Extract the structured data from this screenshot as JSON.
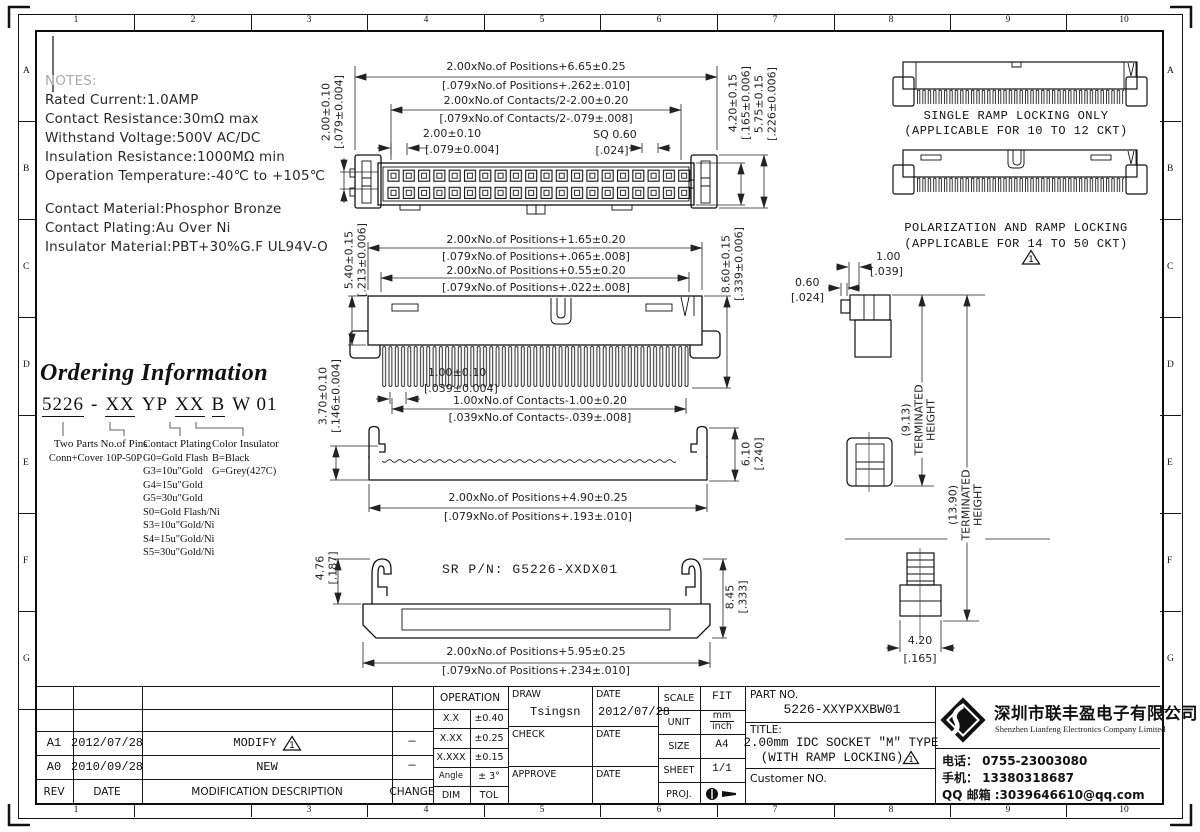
{
  "frame": {
    "top_numbers": [
      "1",
      "2",
      "3",
      "4",
      "5",
      "6",
      "7",
      "8",
      "9",
      "10"
    ],
    "bottom_numbers": [
      "1",
      "2",
      "3",
      "4",
      "5",
      "6",
      "7",
      "8",
      "9",
      "10"
    ],
    "left_letters": [
      "A",
      "B",
      "C",
      "D",
      "E",
      "F",
      "G"
    ],
    "right_letters": [
      "A",
      "B",
      "C",
      "D",
      "E",
      "F",
      "G"
    ]
  },
  "notes": {
    "heading": "NOTES:",
    "electrical": [
      "Rated Current:1.0AMP",
      "Contact Resistance:30mΩ max",
      "Withstand Voltage:500V AC/DC",
      "Insulation Resistance:1000MΩ min",
      "Operation Temperature:-40℃ to +105℃"
    ],
    "material": [
      "Contact Material:Phosphor Bronze",
      "Contact Plating:Au Over Ni",
      "Insulator Material:PBT+30%G.F UL94V-O"
    ]
  },
  "ordering": {
    "title": "Ordering Information",
    "code": {
      "seg1": "5226",
      "seg2": "-",
      "seg3": "XX",
      "seg4": "YP",
      "seg5": "XX",
      "seg6": "B",
      "seg7": "W 01"
    },
    "col1": {
      "line1": "Two Parts",
      "line2": "Conn+Cover"
    },
    "col2": {
      "line1": "No.of Pins",
      "line2": "10P-50P"
    },
    "col3": {
      "title": "Contact Plating",
      "options": [
        "G0=Gold Flash",
        "G3=10u\"Gold",
        "G4=15u\"Gold",
        "G5=30u\"Gold",
        "S0=Gold Flash/Ni",
        "S3=10u\"Gold/Ni",
        "S4=15u\"Gold/Ni",
        "S5=30u\"Gold/Ni"
      ]
    },
    "col4": {
      "title": "Color Insulator",
      "options": [
        "B=Black",
        "G=Grey(427C)"
      ]
    }
  },
  "dims": {
    "v1_pos_mm": "2.00xNo.of Positions+6.65±0.25",
    "v1_pos_in": "[.079xNo.of Positions+.262±.010]",
    "v1_cont_mm": "2.00xNo.of Contacts/2-2.00±0.20",
    "v1_cont_in": "[.079xNo.of Contacts/2-.079±.008]",
    "v1_pitch_mm": "2.00±0.10",
    "v1_pitch_in": "[.079±0.004]",
    "v1_sq_mm": "SQ 0.60",
    "v1_sq_in": "[.024]",
    "v1_row_mm": "2.00±0.10",
    "v1_row_in": "[.079±0.004]",
    "v1_h1_mm": "4.20±0.15",
    "v1_h1_in": "[.165±0.006]",
    "v1_h2_mm": "5.75±0.15",
    "v1_h2_in": "[.226±0.006]",
    "v2_pos1_mm": "2.00xNo.of Positions+1.65±0.20",
    "v2_pos1_in": "[.079xNo.of Positions+.065±.008]",
    "v2_pos2_mm": "2.00xNo.of Positions+0.55±0.20",
    "v2_pos2_in": "[.079xNo.of Positions+.022±.008]",
    "v2_left_mm": "5.40±0.15",
    "v2_left_in": "[.213±0.006]",
    "v2_right_mm": "8.60±0.15",
    "v2_right_in": "[.339±0.006]",
    "v2_pitch_mm": "1.00±0.10",
    "v2_pitch_in": "[.039±0.004]",
    "v2_cont_mm": "1.00xNo.of Contacts-1.00±0.20",
    "v2_cont_in": "[.039xNo.of Contacts-.039±.008]",
    "v2_wall_mm": "3.70±0.10",
    "v2_wall_in": "[.146±0.004]",
    "v3_h_mm": "6.10",
    "v3_h_in": "[.240]",
    "v3_pos_mm": "2.00xNo.of Positions+4.90±0.25",
    "v3_pos_in": "[.079xNo.of Positions+.193±.010]",
    "v4_srpn": "SR P/N: G5226-XXDX01",
    "v4_hook_mm": "4.76",
    "v4_hook_in": "[.187]",
    "v4_h_mm": "8.45",
    "v4_h_in": "[.333]",
    "v4_pos_mm": "2.00xNo.of Positions+5.95±0.25",
    "v4_pos_in": "[.079xNo.of Positions+.234±.010]",
    "s_w1_mm": "1.00",
    "s_w1_in": "[.039]",
    "s_w2_mm": "0.60",
    "s_w2_in": "[.024]",
    "s_th1": "(9.13)",
    "s_th2": "(13.90)",
    "s_th_l1": "TERMINATED",
    "s_th_l2": "HEIGHT",
    "s_base_mm": "4.20",
    "s_base_in": "[.165]"
  },
  "right_section": {
    "caption1_line1": "SINGLE RAMP LOCKING ONLY",
    "caption1_line2": "(APPLICABLE FOR 10 TO 12 CKT)",
    "caption2_line1": "POLARIZATION AND RAMP LOCKING",
    "caption2_line2": "(APPLICABLE FOR 14 TO 50 CKT)"
  },
  "rev_triangle": "1",
  "title_block": {
    "revisions": {
      "headers": {
        "rev": "REV",
        "date": "DATE",
        "desc": "MODIFICATION  DESCRIPTION",
        "change": "CHANGE"
      },
      "rows": [
        {
          "rev": "A1",
          "date": "2012/07/28",
          "desc": "MODIFY",
          "change": "—"
        },
        {
          "rev": "A0",
          "date": "2010/09/28",
          "desc": "NEW",
          "change": "—"
        }
      ]
    },
    "operation": {
      "header": "OPERATION",
      "rows": [
        [
          "X.X",
          "±0.40"
        ],
        [
          "X.XX",
          "±0.25"
        ],
        [
          "X.XXX",
          "±0.15"
        ],
        [
          "Angle",
          "± 3°"
        ],
        [
          "DIM",
          "TOL"
        ]
      ]
    },
    "sign": {
      "draw_label": "DRAW",
      "draw_name": "Tsingsn",
      "date_label1": "DATE",
      "draw_date": "2012/07/28",
      "check_label": "CHECK",
      "date_label2": "DATE",
      "approve_label": "APPROVE",
      "date_label3": "DATE"
    },
    "info": {
      "scale_label": "SCALE",
      "scale": "FIT",
      "unit_label": "UNIT",
      "unit_top": "mm",
      "unit_bottom": "inch",
      "size_label": "SIZE",
      "size": "A4",
      "sheet_label": "SHEET",
      "sheet": "1/1",
      "proj_label": "PROJ."
    },
    "part": {
      "label": "PART NO.",
      "value": "5226-XXYPXXBW01",
      "title_label": "TITLE:",
      "title1": "2.00mm IDC SOCKET \"M\" TYPE",
      "title2": "(WITH RAMP LOCKING)",
      "customer": "Customer NO."
    },
    "company": {
      "cn": "深圳市联丰盈电子有限公司",
      "en": "Shenzhen Lianfeng Electronics Company Limited",
      "tel": "电话： 0755-23003080",
      "mobile": "手机： 13380318687",
      "qq": "QQ 邮箱 :3039646610@qq.com"
    }
  }
}
